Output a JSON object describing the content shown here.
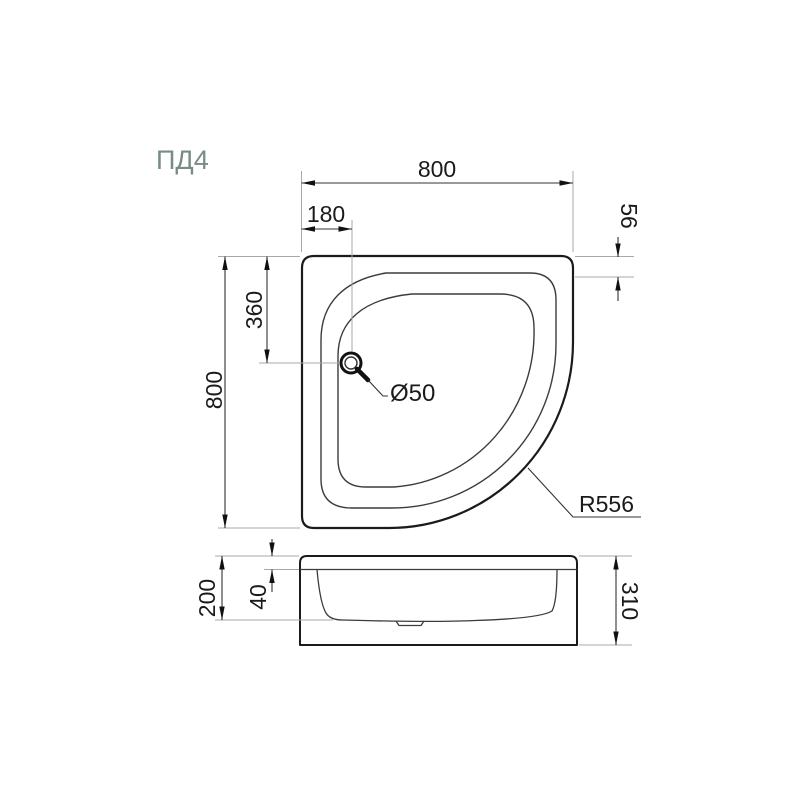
{
  "title": {
    "text": "ПД4",
    "color": "#778c83"
  },
  "colors": {
    "background": "#ffffff",
    "main_outline": "#1b1b1b",
    "inner_contour": "#3c3c3c",
    "dimension_line": "#333333",
    "extension_line": "#a8a8a8",
    "dimension_text": "#1a1a1a"
  },
  "drawing": {
    "subject": "quarter-circle shower tray technical drawing",
    "plan_view": {
      "overall_width": "800",
      "drain_offset_x": "180",
      "rim_width": "56",
      "drain_offset_y": "360",
      "overall_depth": "800",
      "drain_diameter": "Ø50",
      "front_radius": "R556"
    },
    "front_view": {
      "basin_depth": "200",
      "rim_height": "40",
      "total_height": "310"
    }
  }
}
